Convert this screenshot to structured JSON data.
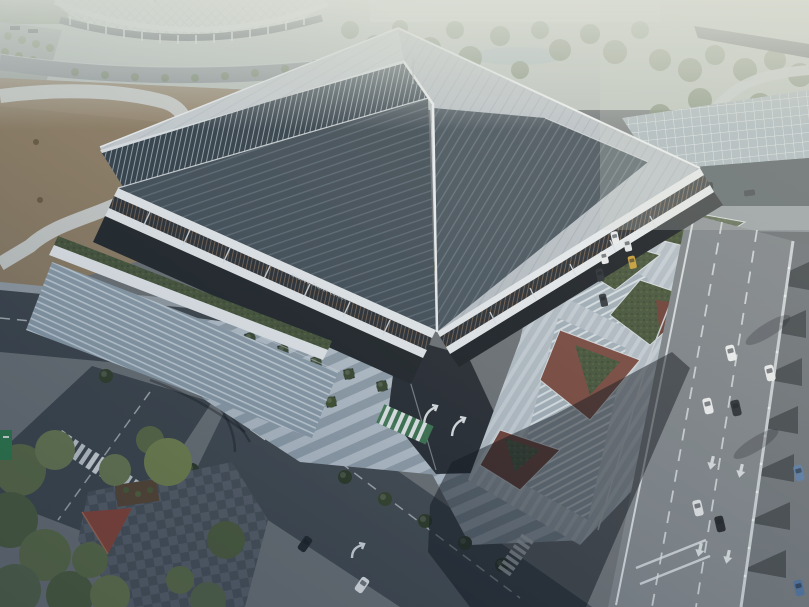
{
  "title": "Aerial drone photograph of a modern transit building with an angular photovoltaic roof at dusk",
  "building": {
    "sign_zh": "顺德旅游中心",
    "sign_en": "Shunde Travel Center",
    "description": "Large pavilion with a faceted diamond roof covered in dark solar panels, white fascia bands, glass clerestory, green roof terraces, grand entry stairs and an under-building drop-off ramp"
  },
  "surroundings": {
    "stadium": "white lattice-roofed arena in top-left background",
    "park": "hazy tree park with pond and distant pale field at top",
    "canopy": "gridded station canopy at the building's right",
    "dirt_field": "bare tan ground with a light S-shaped footpath on the left",
    "intersection": "signalized crossing with zebra crosswalks at bottom-left",
    "plaza": "striped paving forecourt with young trees in square planters and a blue totem sign",
    "landscape_beds": "angular planting beds with green shrubs and red groundcover beside the main road",
    "corner_park": "dense trees, checkered paving and a red pavilion roof in the bottom-left corner",
    "green_banner": "small green vertical banner at the left edge"
  },
  "traffic": {
    "main_road_vehicles": 14,
    "vehicle_colors": [
      "white",
      "dark gray",
      "yellow",
      "blue"
    ],
    "markings": [
      "dashed lane lines",
      "down arrows",
      "turn arrows",
      "zebra crossings",
      "green-and-white crosswalk"
    ]
  },
  "palette": {
    "haze": "#ccd3cf",
    "roof_light": "#c9d0d5",
    "roof_solar": "#43505a",
    "fascia_white": "#e8edf1",
    "glass": "#33404a",
    "terrace_green": "#46553c",
    "dirt": "#8f7f66",
    "road_dark": "#3f474e",
    "road_light": "#7e858b",
    "plaza_light": "#b7c3ce",
    "plaza_mid": "#93a2ae",
    "tree_green": "#5d6d47",
    "sign_red": "#c0392b",
    "totem_blue": "#2456a0",
    "crosswalk_green": "#3e7a54",
    "taxi_yellow": "#c8a13b",
    "car_blue": "#5e7fa8",
    "pavilion_red": "#8a4538",
    "banner_green": "#2f7d4e"
  }
}
